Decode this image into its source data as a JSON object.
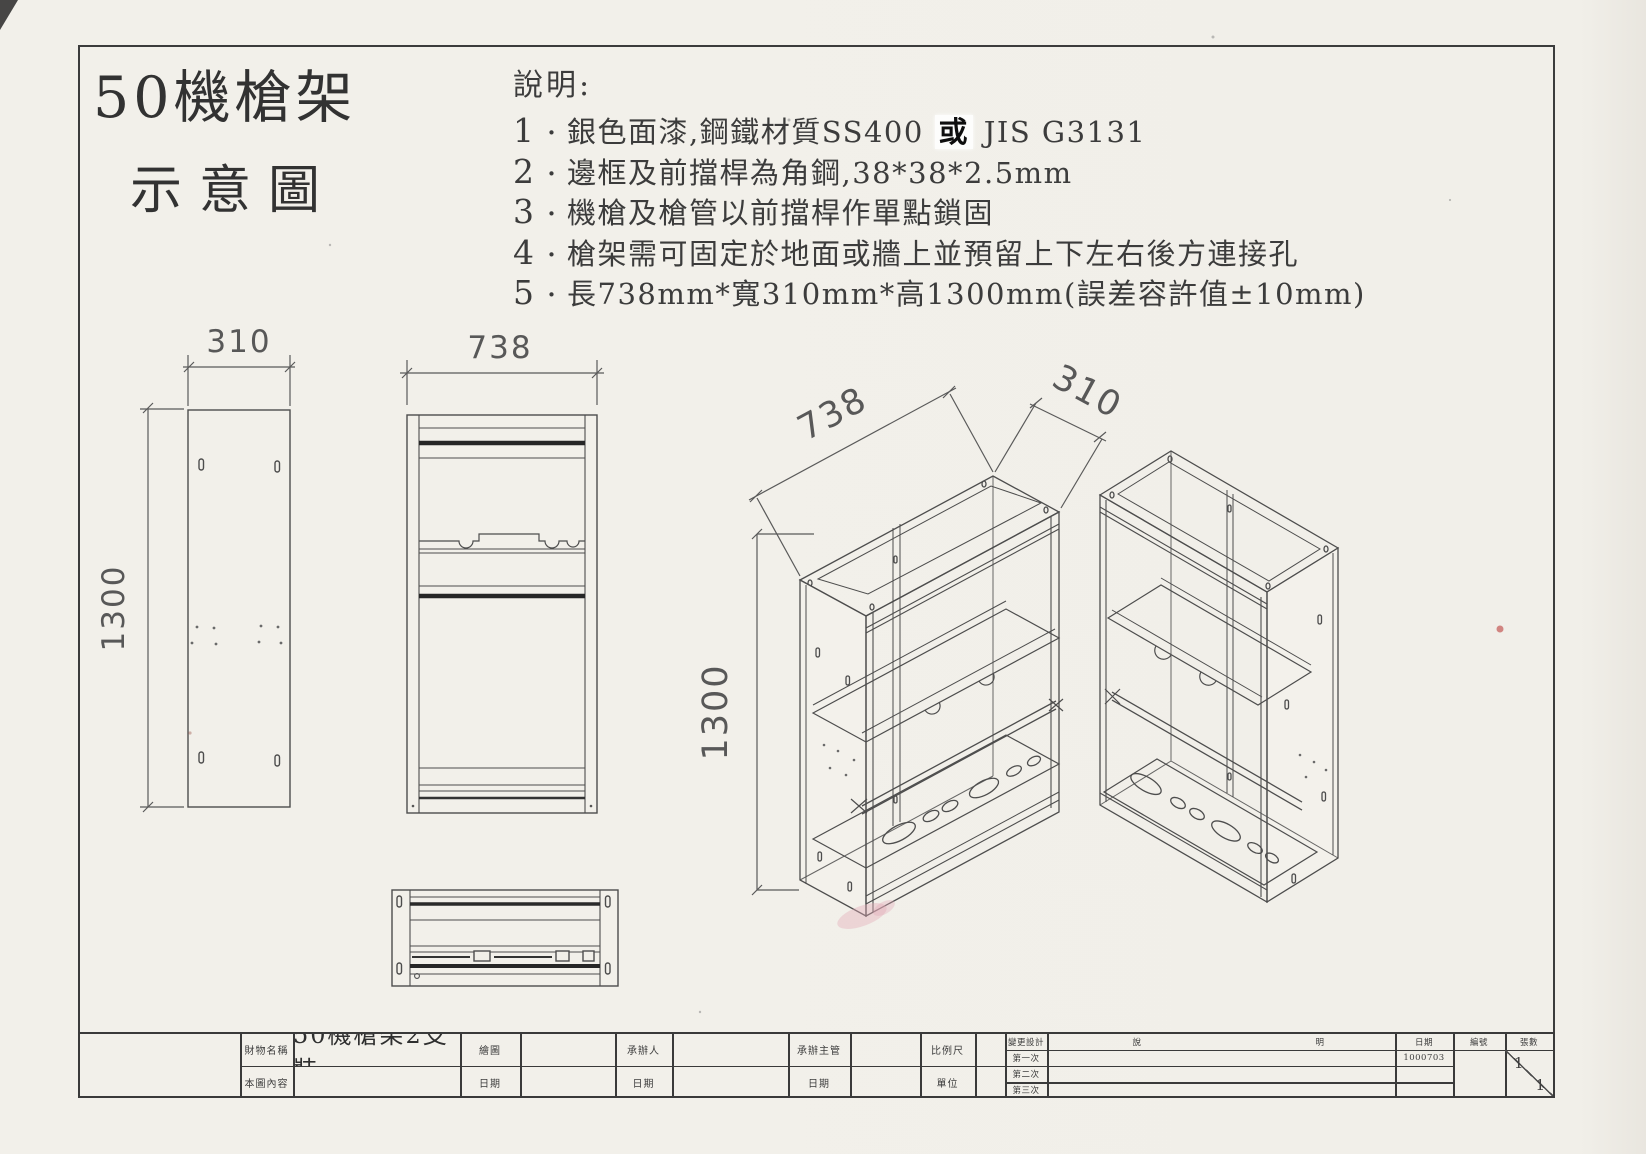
{
  "page": {
    "title_line1": "50機槍架",
    "title_line2": "示意圖"
  },
  "notes": {
    "heading": "說明:",
    "bullet": "・",
    "items": [
      {
        "num": "1",
        "pre": "銀色面漆,鋼鐵材質SS400 ",
        "patch": "或",
        "post": " JIS G3131"
      },
      {
        "num": "2",
        "pre": "邊框及前擋桿為角鋼,38*38*2.5mm",
        "patch": "",
        "post": ""
      },
      {
        "num": "3",
        "pre": "機槍及槍管以前擋桿作單點鎖固",
        "patch": "",
        "post": ""
      },
      {
        "num": "4",
        "pre": "槍架需可固定於地面或牆上並預留上下左右後方連接孔",
        "patch": "",
        "post": ""
      },
      {
        "num": "5",
        "pre": "長738mm*寬310mm*高1300mm(誤差容許值±10mm)",
        "patch": "",
        "post": ""
      }
    ]
  },
  "dimensions": {
    "side_width": "310",
    "side_height": "1300",
    "front_width": "738",
    "iso_length": "738",
    "iso_depth": "310",
    "iso_height": "1300"
  },
  "title_block": {
    "property_name_label": "財物名稱",
    "property_name": "50機槍架2支裝",
    "content_label": "本圖內容",
    "drawn_by_label": "繪圖",
    "handler_label": "承辦人",
    "supervisor_label": "承辦主管",
    "date_label": "日期",
    "scale_label": "比例尺",
    "unit_label": "單位",
    "change_design_label": "變更設計",
    "change_rows": [
      "第一次",
      "第二次",
      "第三次"
    ],
    "desc_left": "說",
    "desc_right": "明",
    "date_header": "日期",
    "first_change_date": "1000703",
    "number_label": "編號",
    "sheet_label": "張數",
    "sheet_current": "1",
    "sheet_total": "1"
  }
}
